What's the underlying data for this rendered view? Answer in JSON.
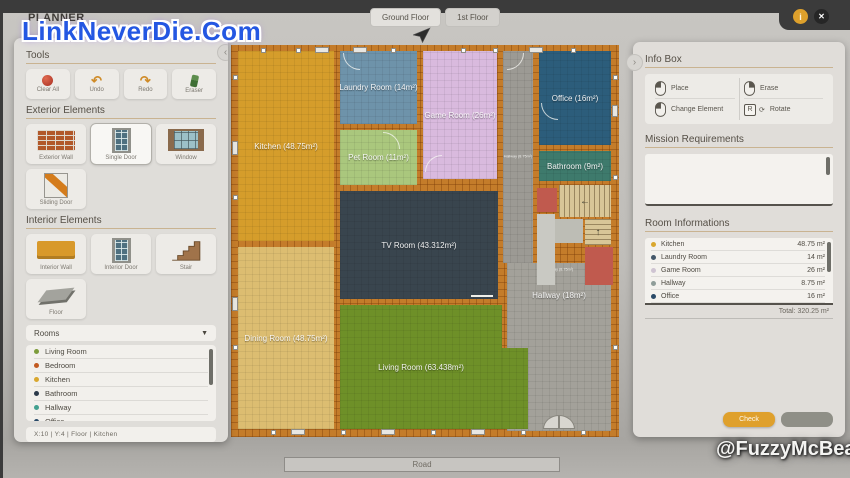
{
  "watermarks": {
    "top_left": "LinkNeverDie.Com",
    "bottom_right": "@FuzzyMcBear"
  },
  "header": {
    "title": "PLANNER",
    "tabs": [
      {
        "label": "Ground Floor"
      },
      {
        "label": "1st Floor"
      }
    ],
    "info_icon_glyph": "i",
    "close_icon_glyph": "✕"
  },
  "icons": {
    "dropdown_arrow": "▼",
    "panel_collapse_left": "‹",
    "panel_collapse_right": "›"
  },
  "left_panel": {
    "tools": {
      "title": "Tools",
      "buttons": [
        {
          "label": "Clear All"
        },
        {
          "label": "Undo",
          "glyph": "↶"
        },
        {
          "label": "Redo",
          "glyph": "↷"
        },
        {
          "label": "Eraser"
        }
      ]
    },
    "exterior_elements": {
      "title": "Exterior Elements",
      "items": [
        {
          "label": "Exterior Wall"
        },
        {
          "label": "Single Door",
          "selected": true
        },
        {
          "label": "Window"
        },
        {
          "label": "Sliding Door"
        }
      ]
    },
    "interior_elements": {
      "title": "Interior Elements",
      "items": [
        {
          "label": "Interior Wall"
        },
        {
          "label": "Interior Door"
        },
        {
          "label": "Stair"
        },
        {
          "label": "Floor"
        }
      ]
    },
    "rooms_dropdown": {
      "label": "Rooms",
      "items": [
        {
          "label": "Living Room",
          "color": "#7d9c3b"
        },
        {
          "label": "Bedroom",
          "color": "#c25a21"
        },
        {
          "label": "Kitchen",
          "color": "#d9a72e"
        },
        {
          "label": "Bathroom",
          "color": "#2c3a4a"
        },
        {
          "label": "Hallway",
          "color": "#43a08f"
        },
        {
          "label": "Office",
          "color": "#2a4a68"
        }
      ]
    },
    "status_bar": "X:10   |   Y:4   |   Floor   |   Kitchen"
  },
  "plan": {
    "rooms": [
      {
        "name": "Kitchen",
        "label": "Kitchen (48.75m²)",
        "color": "#d59d2b"
      },
      {
        "name": "Laundry Room",
        "label": "Laundry Room (14m²)",
        "color": "#6e93aa"
      },
      {
        "name": "Pet Room",
        "label": "Pet Room (11m²)",
        "color": "#aac77d"
      },
      {
        "name": "Game Room",
        "label": "Game Room (26m²)",
        "color": "#d9bade"
      },
      {
        "name": "Hallway small",
        "label": "Hallway (8.75m²)",
        "color": "#9c9a94"
      },
      {
        "name": "Office",
        "label": "Office (16m²)",
        "color": "#2c5d7b"
      },
      {
        "name": "Bathroom",
        "label": "Bathroom (9m²)",
        "color": "#3e7a6c"
      },
      {
        "name": "TV Room",
        "label": "TV Room (43.312m²)",
        "color": "#39454e"
      },
      {
        "name": "Hallway",
        "label": "Hallway (18m²)",
        "color": "#a3a19a"
      },
      {
        "name": "Dining Room",
        "label": "Dining Room (48.75m²)",
        "color": "#dcbd71"
      },
      {
        "name": "Living Room",
        "label": "Living Room (63.438m²)",
        "color": "#6e9028"
      }
    ],
    "stair_arrow_left": "←",
    "stair_arrow_up": "↑",
    "road_label": "Road"
  },
  "right_panel": {
    "info_box": {
      "title": "Info Box",
      "actions": [
        {
          "label": "Place"
        },
        {
          "label": "Erase"
        },
        {
          "label": "Change Element"
        },
        {
          "label": "Rotate",
          "key": "R",
          "glyph": "⟳"
        }
      ]
    },
    "mission_requirements": {
      "title": "Mission Requirements",
      "content": ""
    },
    "room_informations": {
      "title": "Room Informations",
      "rows": [
        {
          "name": "Kitchen",
          "value": "48.75 m²",
          "color": "#d9a72e"
        },
        {
          "name": "Laundry Room",
          "value": "14 m²",
          "color": "#44586a"
        },
        {
          "name": "Game Room",
          "value": "26 m²",
          "color": "#cfc4d2"
        },
        {
          "name": "Hallway",
          "value": "8.75 m²",
          "color": "#8f9d99"
        },
        {
          "name": "Office",
          "value": "16 m²",
          "color": "#2a4a68"
        }
      ],
      "total": "Total: 320.25 m²"
    },
    "check_button": "Check",
    "secondary_button": ""
  }
}
